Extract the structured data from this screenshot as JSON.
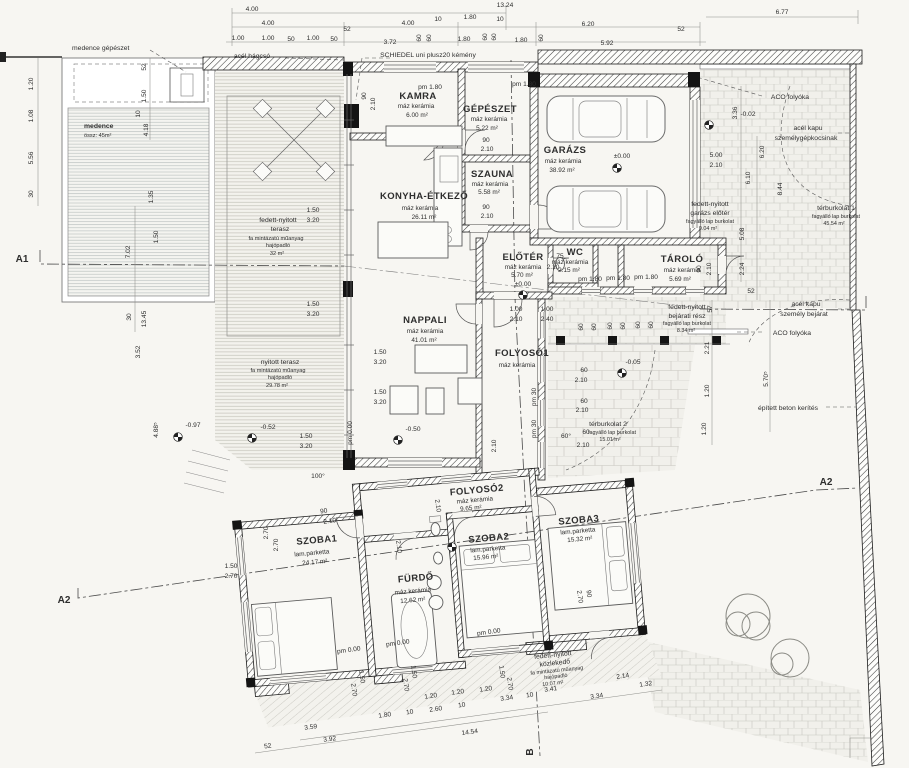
{
  "rooms": [
    {
      "name": "KAMRA",
      "finish": "máz kerámia",
      "area": "6.00 m²"
    },
    {
      "name": "GÉPÉSZET",
      "finish": "máz kerámia",
      "area": "5.22 m²"
    },
    {
      "name": "SZAUNA",
      "finish": "máz kerámia",
      "area": "5.58 m²"
    },
    {
      "name": "KONYHA-ÉTKEZŐ",
      "finish": "máz kerámia",
      "area": "26.11 m²"
    },
    {
      "name": "GARÁZS",
      "finish": "máz kerámia",
      "area": "38.92 m²"
    },
    {
      "name": "ELŐTÉR",
      "finish": "máz kerámia",
      "area": "5.70 m²"
    },
    {
      "name": "WC",
      "finish": "máz kerámia",
      "area": "2.15 m²"
    },
    {
      "name": "TÁROLÓ",
      "finish": "máz kerámia",
      "area": "5.69 m²"
    },
    {
      "name": "NAPPALI",
      "finish": "máz kerámia",
      "area": "41.01 m²"
    },
    {
      "name": "FOLYOSÓ1",
      "finish": "máz kerámia",
      "area": ""
    },
    {
      "name": "FOLYOSÓ2",
      "finish": "máz kerámia",
      "area": "9.65 m²"
    },
    {
      "name": "SZOBA1",
      "finish": "lam.parketta",
      "area": "24.17 m²"
    },
    {
      "name": "FÜRDŐ",
      "finish": "máz kerámia",
      "area": "12.62 m²"
    },
    {
      "name": "SZOBA2",
      "finish": "lam.parketta",
      "area": "15.96 m²"
    },
    {
      "name": "SZOBA3",
      "finish": "lam.parketta",
      "area": "15.32 m²"
    }
  ],
  "outdoor": {
    "medence": {
      "name": "medence",
      "sub": "össz: 45m²"
    },
    "terasz1": {
      "l1": "fedett-nyitott",
      "l2": "terasz",
      "l3": "fa mintázatú műanyag",
      "l4": "hajópadló",
      "l5": "32 m²"
    },
    "terasz2": {
      "l1": "nyitott terasz",
      "l2": "fa mintázatú műanyag",
      "l3": "hajópadló",
      "l4": "29.78 m²"
    },
    "garazs_eloter": {
      "l1": "fedett-nyitott",
      "l2": "garázs előtér",
      "l3": "fagyálló lap burkolat",
      "l4": "9.04 m²"
    },
    "bejarati": {
      "l1": "fedett-nyitott",
      "l2": "bejárati rész",
      "l3": "fagyálló lap burkolat",
      "l4": "8.34 m²"
    },
    "terburkolat1": {
      "l1": "térburkolat 1",
      "l2": "fagyálló lap burkolat",
      "l3": "45.54 m²"
    },
    "terburkolat2": {
      "l1": "térburkolat 2",
      "l2": "fagyálló lap burkolat",
      "l3": "15.01 m²"
    },
    "kozlekedo": {
      "l1": "fedett-nyitott",
      "l2": "közlekedő",
      "l3": "fa mintázatú műanyag",
      "l4": "hajópadló",
      "l5": "10.07 m²"
    }
  },
  "annotations": {
    "medence_gepeszet": "medence gépészet",
    "acel_hagcso": "acél hágcsó",
    "kemeny": "SCHIEDEL uni plusz20 kémény",
    "aco1": "ACO folyóka",
    "kapu_auto_l1": "acél kapu",
    "kapu_auto_l2": "személygépkocsinak",
    "kapu_szemely_l1": "acél kapu",
    "kapu_szemely_l2": "személy bejárat",
    "aco2": "ACO folyóka",
    "kerites": "épített beton kerítés"
  },
  "markers": {
    "a1": "A1",
    "a2l": "A2",
    "a2r": "A2",
    "b": "B"
  },
  "levels": {
    "zero": "±0.00",
    "zero2": "±0.00",
    "m002": "-0.02",
    "m005": "-0.05",
    "m097": "-0.97",
    "m052": "-0.52",
    "m050": "-0.50"
  },
  "dims": {
    "top": [
      "4.00",
      "13.24",
      "6.77",
      "4.00",
      "52",
      "4.00",
      "10",
      "1.80",
      "10",
      "6.20",
      "52",
      "1.00",
      "1.00",
      "50",
      "1.00",
      "50",
      "3.72",
      "60",
      "60",
      "1.80",
      "60",
      "60",
      "1.80",
      "60",
      "5.92"
    ],
    "left": [
      "1.20",
      "1.08",
      "5.56",
      "30",
      "7.02",
      "1.35",
      "1.50",
      "3.52",
      "30",
      "13.45",
      "4.88⁵",
      "52",
      "1.50",
      "10",
      "4.18",
      "2.70",
      "2.70"
    ],
    "right": [
      "3.36",
      "6.20",
      "6.10",
      "8.44",
      "5.08",
      "2.24",
      "52",
      "57",
      "2.21",
      "1.20",
      "1.20",
      "5.70⁵"
    ],
    "bottom": [
      "52",
      "3.59",
      "3.92",
      "1.80",
      "10",
      "2.60",
      "10",
      "1.20",
      "1.20",
      "1.20",
      "14.54",
      "3.34",
      "10",
      "3.41",
      "3.34",
      "2.14",
      "1.32",
      "2.70",
      "1.50",
      "2.70",
      "1.50",
      "1.50",
      "2.70"
    ],
    "inner": [
      "pm 1.80",
      "pm 1.80",
      "90",
      "2.10",
      "90",
      "2.10",
      "5.00",
      "2.10",
      "75",
      "2.10",
      "pm 1.80",
      "pm 1.80",
      "pm 1.80",
      "1.00",
      "2.10",
      "1.00",
      "2.40",
      "60",
      "60",
      "60",
      "60",
      "60",
      "60",
      "90",
      "2.10",
      "1.50",
      "3.20",
      "1.50",
      "3.20",
      "1.50",
      "3.20",
      "1.50",
      "3.20",
      "1.50",
      "3.20",
      "pm 0.00",
      "100°",
      "60",
      "2.10",
      "60",
      "2.10",
      "60",
      "2.10",
      "60°",
      "pm 30",
      "pm 30",
      "2.10",
      "90",
      "2.10",
      "2.10",
      "pm 0.00",
      "pm 0.00",
      "pm 0.00",
      "90",
      "2.70",
      "1.50",
      "2.70",
      "90",
      "2.10",
      "2.10"
    ]
  }
}
